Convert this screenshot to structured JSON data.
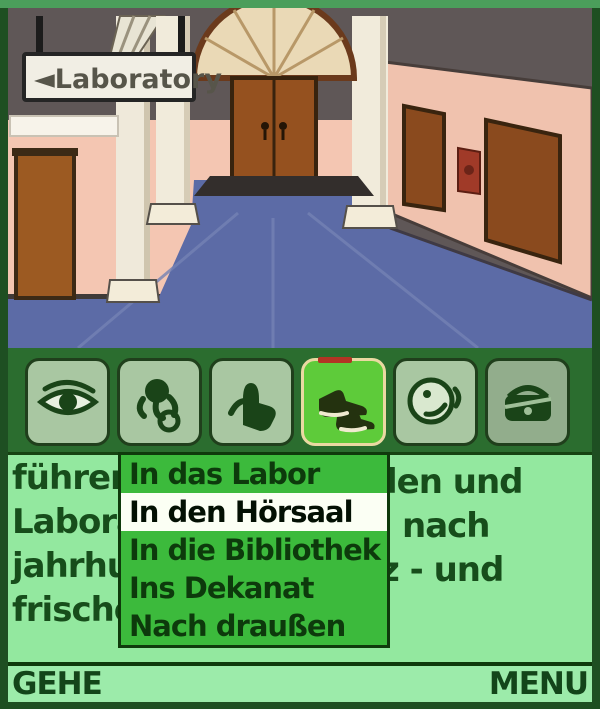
{
  "frame": {
    "border_color": "#1e4f22",
    "top_strip_color": "#4b9e5b"
  },
  "scene": {
    "description": "university hallway with arched double door",
    "sign_text": "◄Laboratory",
    "colors": {
      "ceiling": "#5f5757",
      "wall_pink": "#f4c6b2",
      "floor_blue": "#5c6ba6",
      "door_brown": "#95511f",
      "arch_cream": "#ead9b6",
      "column_white": "#f1ebdb"
    }
  },
  "toolbar": {
    "bg": "#2b6d2f",
    "selected_index": 3,
    "selected_bg": "#5ecb3a",
    "buttons": [
      {
        "icon": "eye-icon",
        "action": "look"
      },
      {
        "icon": "grab-hand-icon",
        "action": "take"
      },
      {
        "icon": "hold-hand-icon",
        "action": "use"
      },
      {
        "icon": "walking-shoes-icon",
        "action": "go"
      },
      {
        "icon": "talking-face-icon",
        "action": "talk"
      },
      {
        "icon": "inventory-bag-icon",
        "action": "inventory"
      }
    ]
  },
  "textpane": {
    "bg": "#93e89f",
    "fragments": [
      "führen",
      "Labora",
      "jahrhu",
      "frische",
      "len und",
      "nach",
      "z - und"
    ]
  },
  "menu": {
    "selected_index": 1,
    "items": [
      "In das Labor",
      "In den Hörsaal",
      "In die Bibliothek",
      "Ins Dekanat",
      "Nach draußen"
    ]
  },
  "softkeys": {
    "left": "GEHE",
    "right": "MENU"
  }
}
